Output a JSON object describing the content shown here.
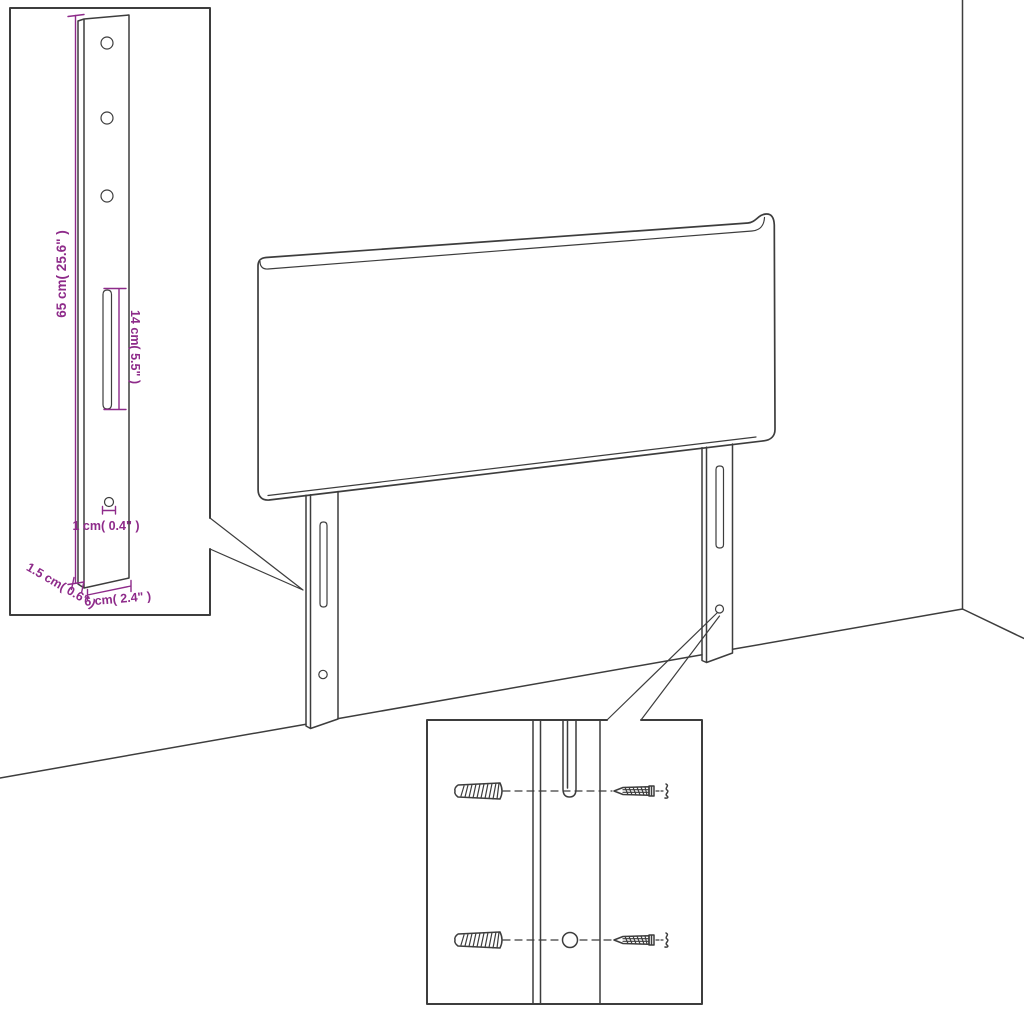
{
  "diagram": {
    "kind": "headboard-assembly-dimension-diagram",
    "colors": {
      "background": "#ffffff",
      "line": "#3d3d3d",
      "dimension": "#8e2b8a"
    },
    "dimensions": {
      "bracket_height": "65 cm( 25.6\" )",
      "slot_length": "14 cm( 5.5\" )",
      "hole_diameter": "1 cm( 0.4\" )",
      "bracket_width": "6 cm( 2.4\" )",
      "bracket_depth": "1.5 cm( 0.6\" )"
    }
  }
}
